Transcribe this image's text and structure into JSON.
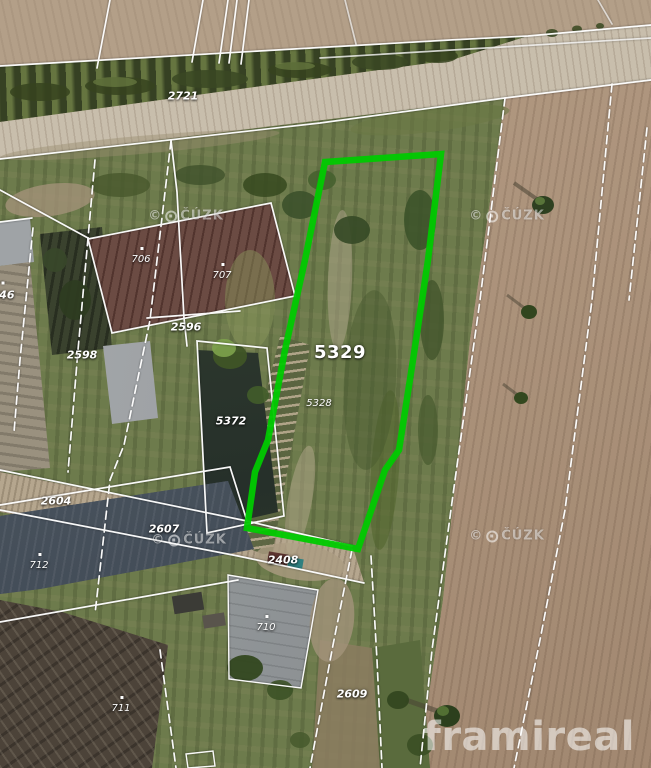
{
  "map": {
    "description": "Aerial cadastral map with highlighted parcel",
    "highlight_color": "#00ca00",
    "boundary_color": "#ffffff",
    "copyright_symbol": "©",
    "watermark_text": "ČÚZK",
    "brand": "framireal",
    "watermarks": [
      {
        "x": 186,
        "y": 216
      },
      {
        "x": 507,
        "y": 216
      },
      {
        "x": 189,
        "y": 540
      },
      {
        "x": 507,
        "y": 536
      }
    ],
    "parcel_labels": [
      {
        "text": "2721",
        "x": 183,
        "y": 96,
        "size": "md"
      },
      {
        "text": "706",
        "x": 141,
        "y": 260,
        "size": "sm",
        "marker": true
      },
      {
        "text": "707",
        "x": 222,
        "y": 276,
        "size": "sm",
        "marker": true
      },
      {
        "text": "2596",
        "x": 186,
        "y": 327,
        "size": "md"
      },
      {
        "text": "2598",
        "x": 82,
        "y": 355,
        "size": "md"
      },
      {
        "text": "5372",
        "x": 231,
        "y": 421,
        "size": "md"
      },
      {
        "text": "5329",
        "x": 340,
        "y": 353,
        "size": "lg"
      },
      {
        "text": "5328",
        "x": 319,
        "y": 404,
        "size": "sm"
      },
      {
        "text": "2604",
        "x": 56,
        "y": 501,
        "size": "md"
      },
      {
        "text": "2607",
        "x": 164,
        "y": 529,
        "size": "md"
      },
      {
        "text": "2408",
        "x": 283,
        "y": 560,
        "size": "md"
      },
      {
        "text": "712",
        "x": 39,
        "y": 566,
        "size": "sm",
        "marker": true
      },
      {
        "text": "710",
        "x": 266,
        "y": 628,
        "size": "sm",
        "marker": true
      },
      {
        "text": "711",
        "x": 121,
        "y": 709,
        "size": "sm",
        "marker": true
      },
      {
        "text": "2609",
        "x": 352,
        "y": 694,
        "size": "md"
      },
      {
        "text": "546",
        "x": 3,
        "y": 295,
        "size": "md",
        "marker": true
      }
    ]
  }
}
